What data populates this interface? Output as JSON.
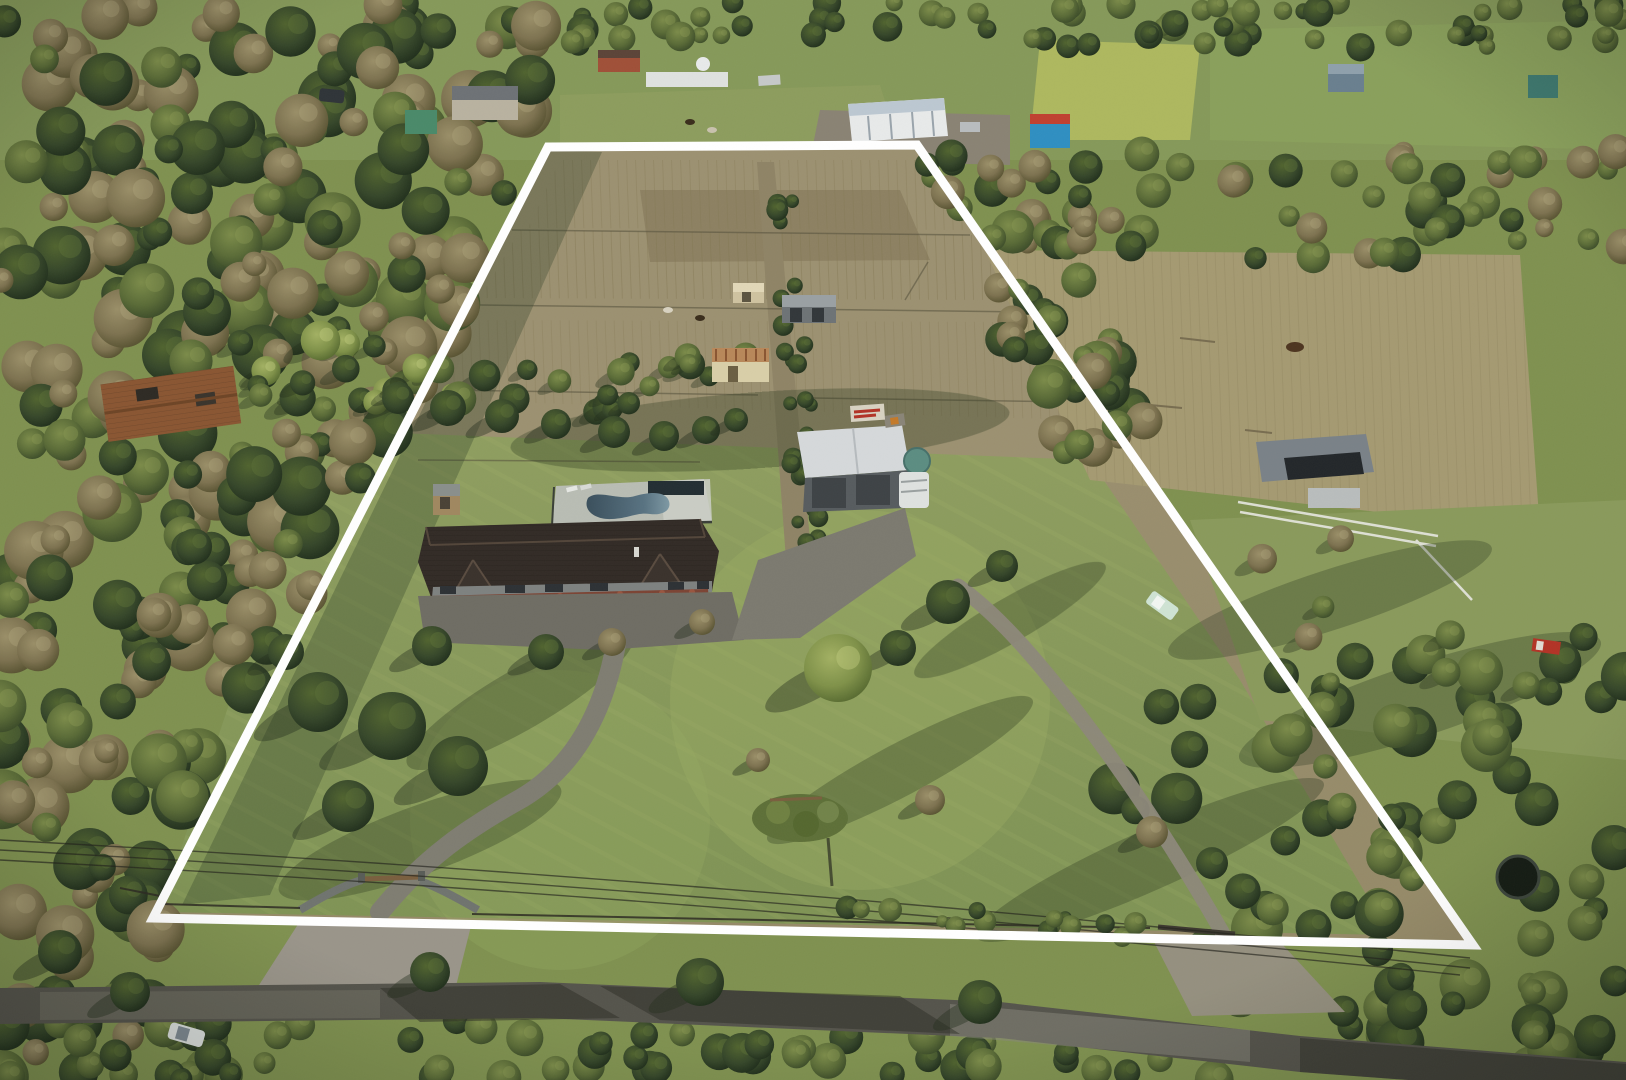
{
  "scene": {
    "type": "aerial-drone-photo",
    "subject": "rural acreage property for sale with white boundary overlay",
    "overlay": {
      "shape": "trapezoid",
      "stroke_width": 9
    },
    "features": [
      "property-boundary",
      "main-house",
      "swimming-pool",
      "pool-deck",
      "large-shed",
      "water-tank",
      "caravan",
      "old-cottage",
      "farm-sheds",
      "plowed-paddocks",
      "central-laneway",
      "front-lawn",
      "entrance-gate",
      "main-driveway",
      "second-driveway",
      "second-gate",
      "country-road",
      "left-forest",
      "neighbour-rust-roof-house",
      "neighbour-barn",
      "horse-paddock",
      "white-car",
      "utility-truck",
      "trampoline",
      "power-lines",
      "distant-farm-buildings"
    ],
    "colors": {
      "boundary": "#ffffff",
      "pool_water": "#44616f",
      "pool_water_light": "#7e99a4",
      "pool_deck": "#b9bdb4",
      "house_roof": "#322b26",
      "house_wall": "#7e8280",
      "hedge_red": "#7c4434",
      "shed_roof": "#d6d9db",
      "shed_wall": "#575c5f",
      "roller_door": "#3e4346",
      "water_tank": "#5c8d82",
      "caravan": "#dfe2e0",
      "lawn": "#8a9c5e",
      "lawn_bright": "#9db065",
      "paddock": "#9c9171",
      "paddock_dark": "#8a7d5f",
      "field_bright": "#aeb85f",
      "forest_base": "#35432a",
      "road": "#55544c",
      "driveway": "#8b867a",
      "gravel": "#9a958a",
      "gate_wall": "#70746f",
      "rust_roof": "#8a5632",
      "cream_cottage": "#d9cfa8",
      "blue_building": "#2f8fc2",
      "white_building": "#e8eaea",
      "grey_barn": "#7a8288",
      "teal_shed": "#3f7a70",
      "white_car": "#d8dcda",
      "mint_ute": "#cfe3d4",
      "red_truck": "#b33326"
    }
  }
}
